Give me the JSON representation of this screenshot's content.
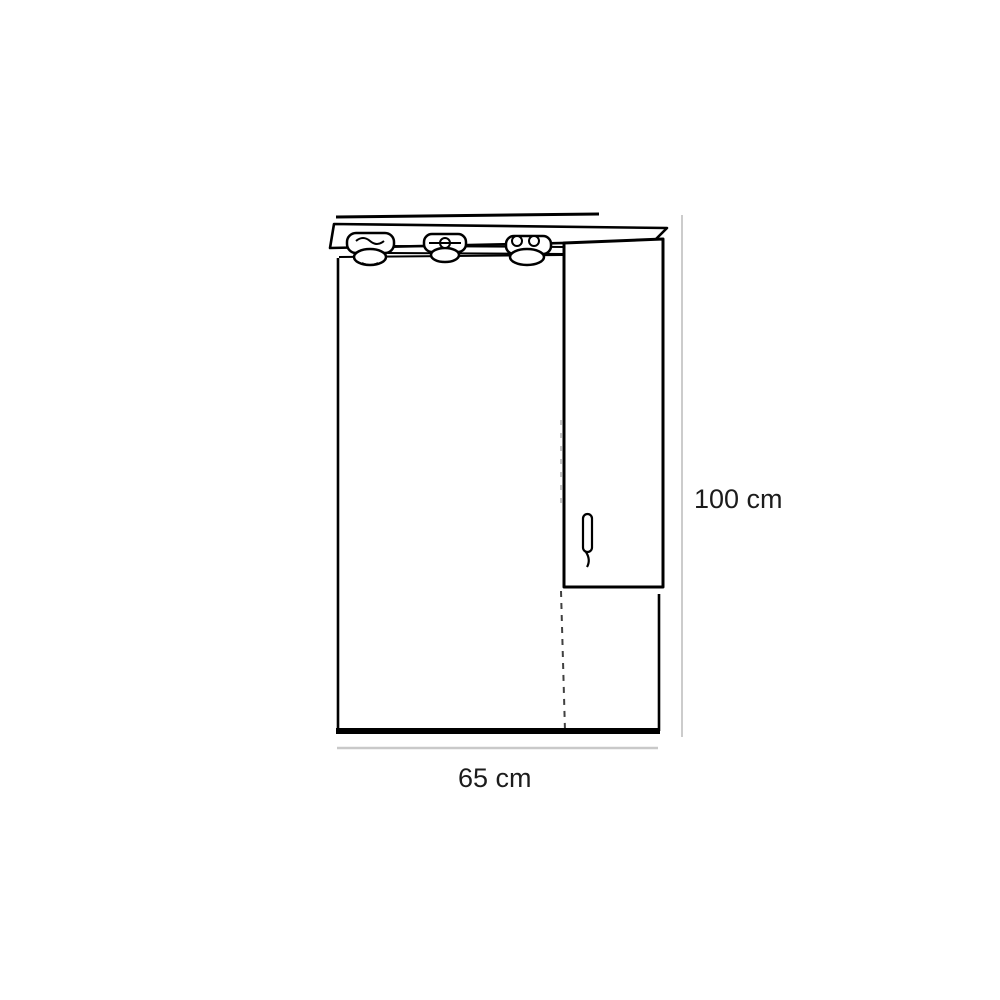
{
  "page": {
    "background_color": "#ffffff"
  },
  "drawing": {
    "kind": "product-dimension-line-drawing",
    "subject": "mirror cabinet with light canopy, side cabinet door and open shelf",
    "lights_count": 3,
    "colors": {
      "line": "#000000",
      "dimension_line": "#cccccc",
      "label_text": "#1c1c1c"
    },
    "height_dimension": {
      "label": "100 cm",
      "value": 100,
      "unit": "cm",
      "orientation": "vertical"
    },
    "width_dimension": {
      "label": "65 cm",
      "value": 65,
      "unit": "cm",
      "orientation": "horizontal"
    }
  }
}
